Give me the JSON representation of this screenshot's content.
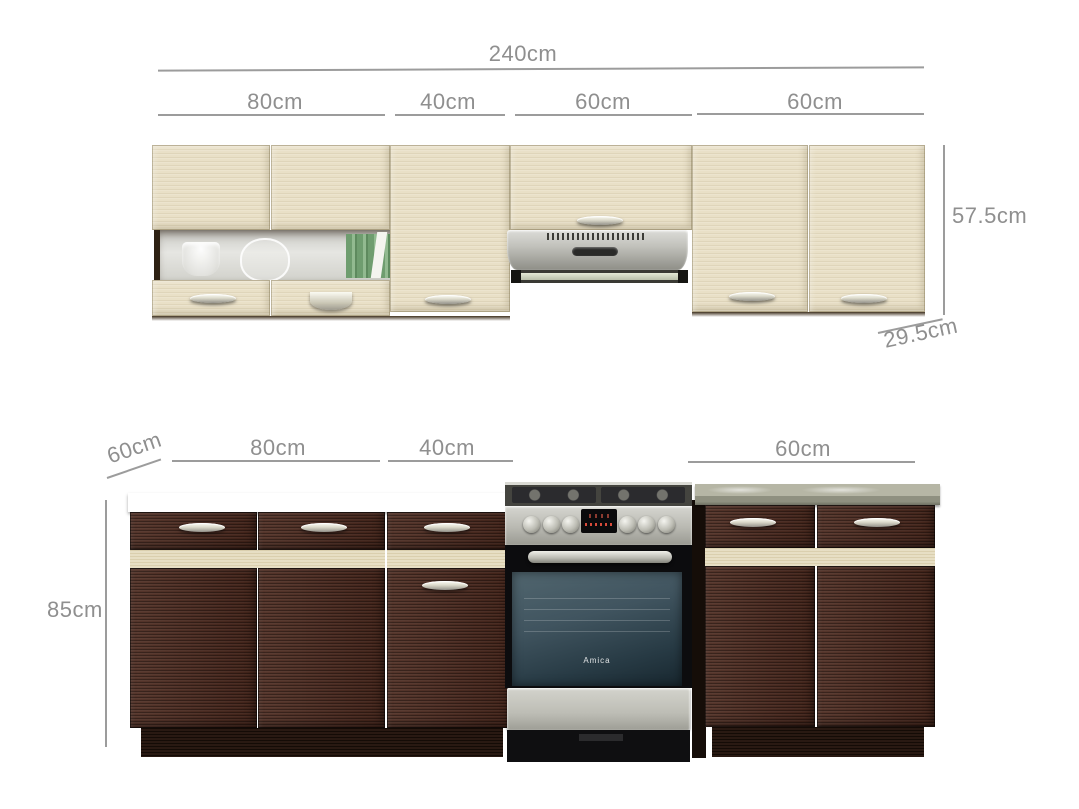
{
  "top_group": {
    "total_label": "240cm",
    "segment_labels": [
      "80cm",
      "40cm",
      "60cm",
      "60cm"
    ],
    "height_label": "57.5cm",
    "depth_label": "29.5cm"
  },
  "bottom_group": {
    "depth_label": "60cm",
    "segment_labels": [
      "80cm",
      "40cm",
      "60cm"
    ],
    "height_label": "85cm"
  },
  "oven": {
    "brand": "Amica"
  },
  "colors": {
    "dimension_line": "#9c9c9c",
    "dimension_text": "#8f8f8f",
    "wall_cabinet_wood": "#e9e0c7",
    "base_cabinet_wood": "#49271c",
    "accent_stripe": "#e3d9ba",
    "countertop": "#ece3c8",
    "stainless_steel": "#c2c2bc",
    "background": "#ffffff"
  }
}
